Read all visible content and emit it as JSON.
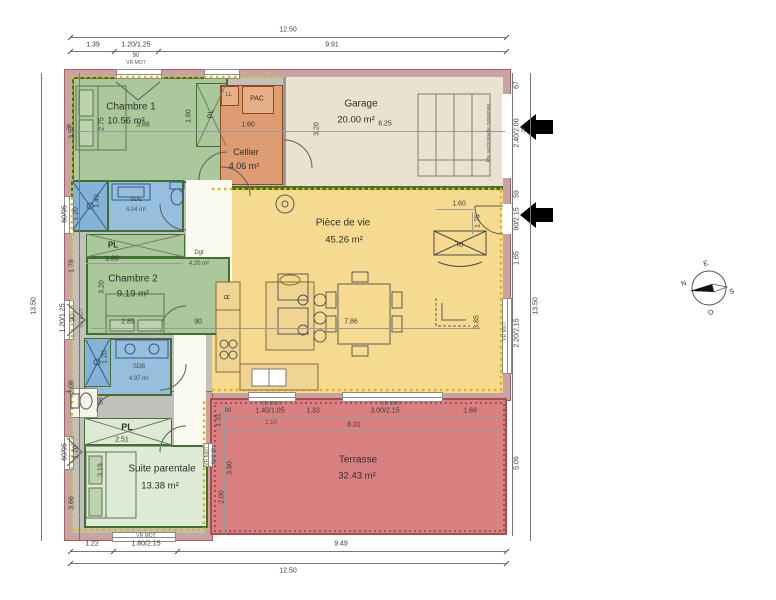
{
  "compass": {
    "n": "N",
    "e": "E",
    "s": "S",
    "o": "O"
  },
  "rooms": {
    "chambre1": {
      "name": "Chambre 1",
      "area": "10.56 m²"
    },
    "cellier": {
      "name": "Cellier",
      "area": "4.06 m²"
    },
    "garage": {
      "name": "Garage",
      "area": "20.00 m²"
    },
    "piece_de_vie": {
      "name": "Pièce de vie",
      "area": "45.26 m²"
    },
    "sde": {
      "name": "SDE",
      "area": "4.04 m²"
    },
    "chambre2": {
      "name": "Chambre 2",
      "area": "9.19 m²"
    },
    "dgt": {
      "name": "Dgt",
      "area": "4.20 m²"
    },
    "sdb": {
      "name": "SDB",
      "area": "4.97 m²"
    },
    "suite": {
      "name": "Suite parentale",
      "area": "13.38 m²"
    },
    "terrasse": {
      "name": "Terrasse",
      "area": "32.43 m²"
    }
  },
  "fixtures": {
    "ll": "LL",
    "pac": "PAC",
    "fridge": "R",
    "closet": "PL"
  },
  "dims": {
    "top": {
      "total": "12.50",
      "s1": "1.39",
      "s2": "1.20/1.25",
      "s3": "9.91",
      "win": "90",
      "motor": "VR MOT"
    },
    "bottom": {
      "s1": "1.22",
      "s2": "1.80/2.15",
      "s3": "9.49",
      "total": "12.50",
      "motor": "VR MOT"
    },
    "left": {
      "total": "13.50",
      "s1": "3.57",
      "s2": "60/95",
      "s2b": "1.20",
      "s3": "1.78",
      "s4": "1.20/1.25",
      "s4b": "90",
      "s5": "2.08",
      "s6": "60/95",
      "s6b": "1.20",
      "s7": "3.66",
      "motor": "VR MOT"
    },
    "right": {
      "total": "13.50",
      "s1": "67",
      "s2": "2.40/2.00",
      "s2b": "22",
      "note": "Pte sectionnelle motorisée",
      "s3": "59",
      "s4": "90/2.15",
      "s5": "1.65",
      "s6": "2.20/2.15",
      "s7": "5.09",
      "motor": "VR MOT"
    },
    "inner": {
      "chambre1_wall": "36",
      "chambre1_h": "2.75",
      "chambre1_w": "3.88",
      "pl1_h": "1.80",
      "cellier_w": "1.60",
      "garage_h": "3.20",
      "garage_w": "6.25",
      "sde_shower": "1.40",
      "pl2_w": "1.80",
      "chambre2_h": "3.20",
      "chambre2_w": "2.89",
      "dgt_door": "90",
      "living_w": "7.86",
      "living_h": "3.85",
      "entry_w": "1.60",
      "entry_h": "1.75",
      "sdb_shower": "1.20",
      "wc_w": "98",
      "pl3_w": "2.51",
      "suite_h": "3.19",
      "suite_win": "60/2.15",
      "motor": "VR MOT"
    },
    "terrasse": {
      "s1": "89",
      "s2": "1.40/1.05",
      "s2b": "1.10",
      "s3": "1.33",
      "s4": "3.00/2.15",
      "s5": "1.69",
      "total": "8.31",
      "l1": "1.31",
      "l2": "3.90",
      "l3": "2.00",
      "motor": "VR MOT"
    }
  }
}
